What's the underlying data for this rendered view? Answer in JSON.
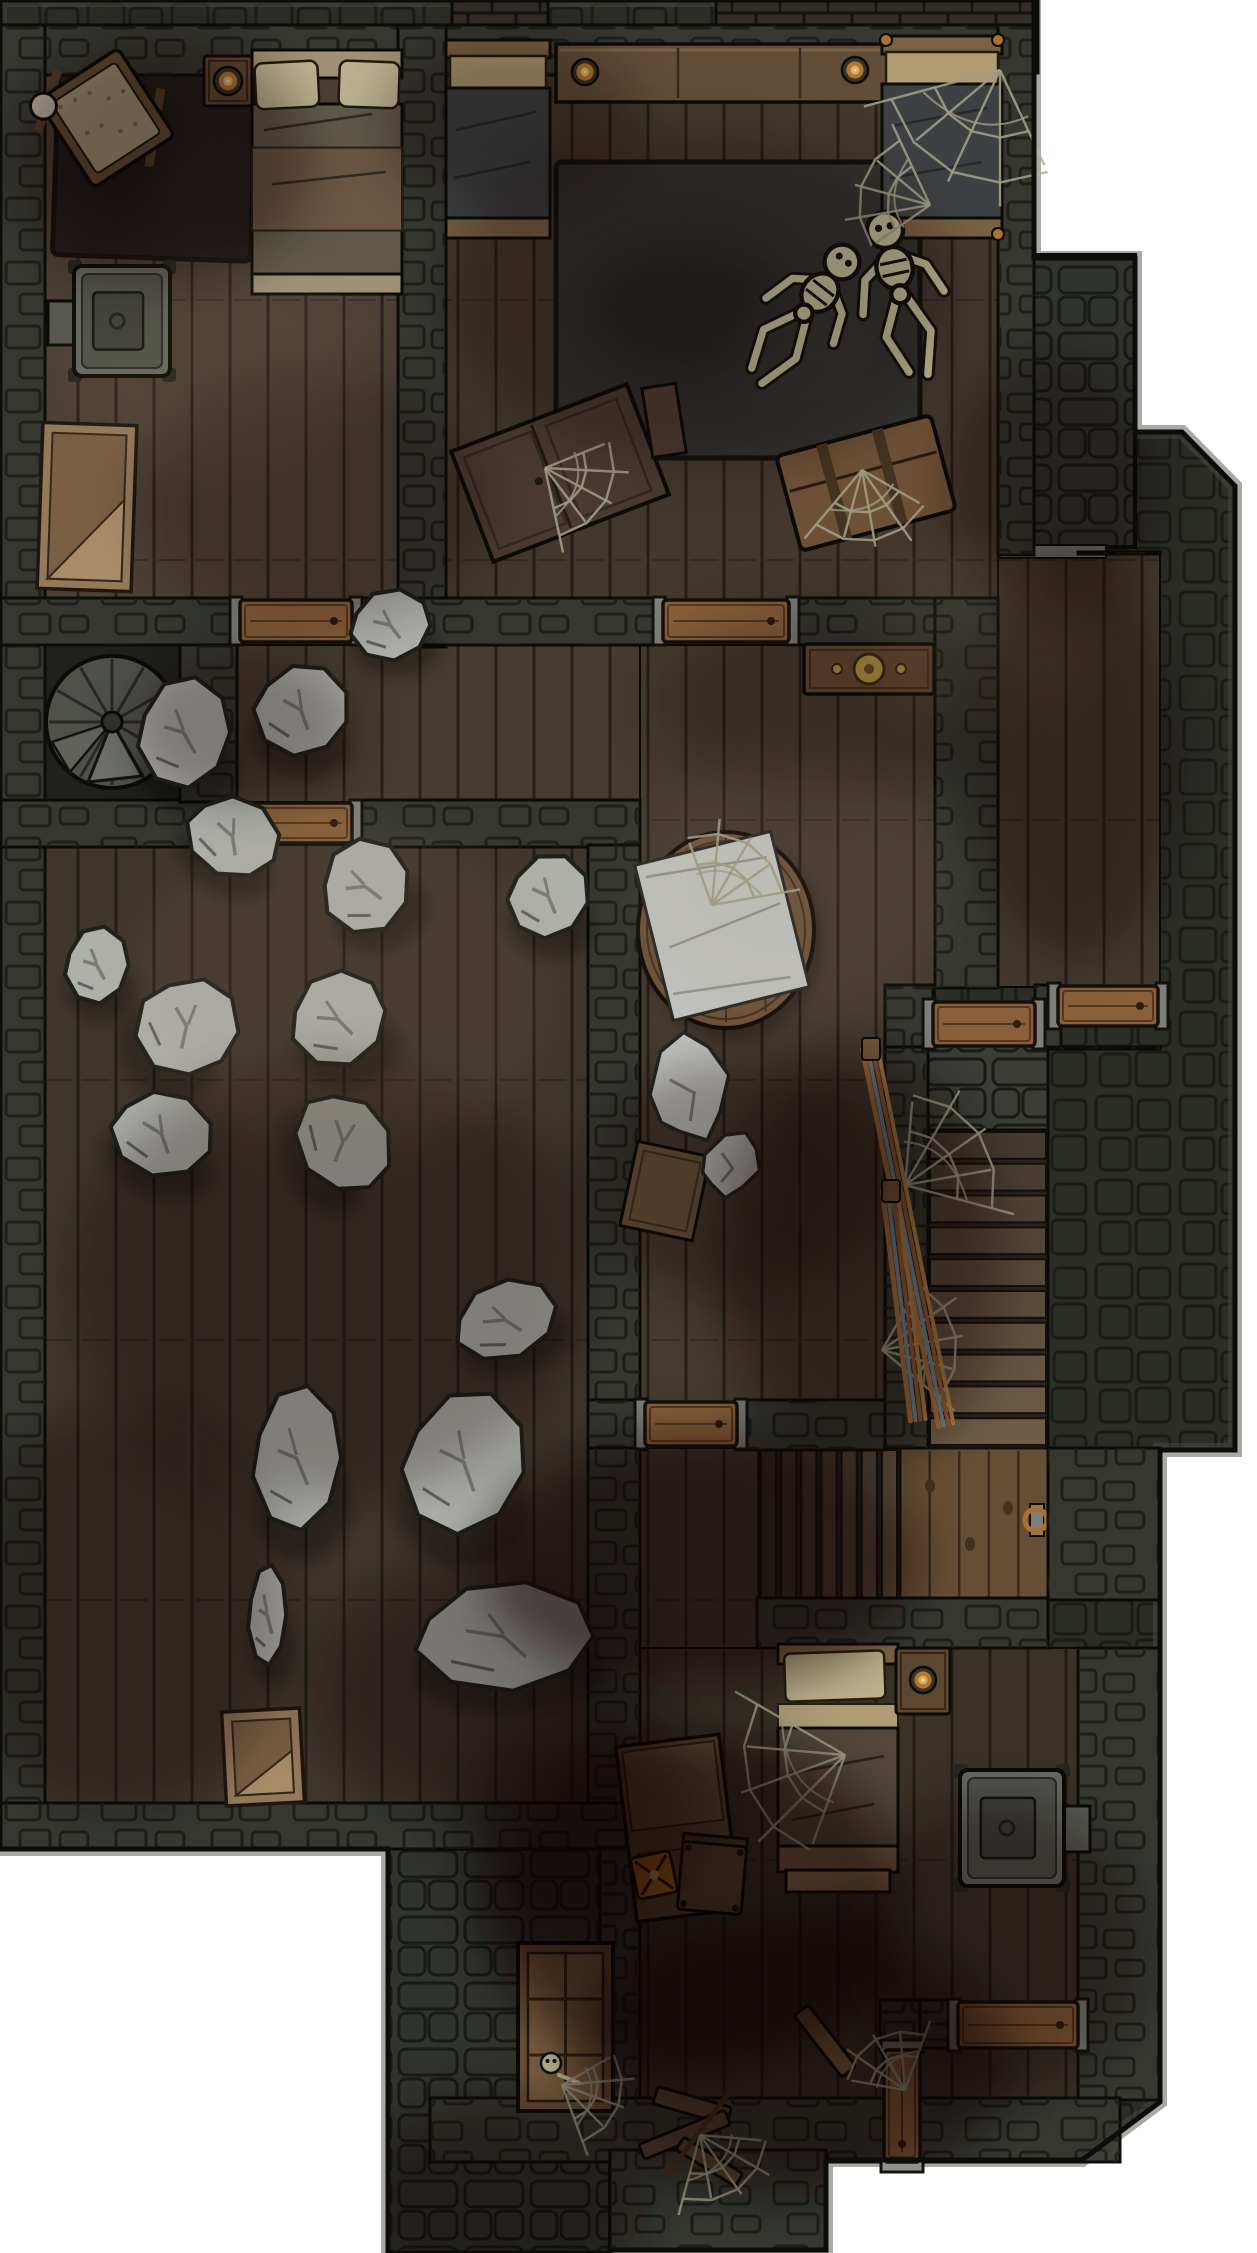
{
  "canvas": {
    "width": 1257,
    "height": 2253,
    "background": "#ffffff"
  },
  "palette": {
    "outline": "#0c0d09",
    "outer_wall": "#31332c",
    "outer_edge": "#54554d",
    "wall_fill": "#3d3f38",
    "brick_line": "#1d1e18",
    "cobble_base": "#383a34",
    "cobble_line": "#181914",
    "crenel_fill": "#3a332d",
    "crenel_line": "#171411",
    "floor_tones": {
      "a": "#57493c",
      "b": "#4c4034",
      "c": "#4f4337",
      "d": "#483d33",
      "e": "#42382e",
      "dark": "#24251f"
    },
    "seam": "rgba(14,10,7,0.55)",
    "door_wood": "#9c6c42",
    "door_edge": "#17120c",
    "door_jamb": "#8f918b",
    "threshold": "#878983",
    "rock_fill": "#c7c9c3",
    "rock_line": "#23241f",
    "rock_crease": "#8b8e88",
    "cloth_fill": "#dcdeda",
    "bone": "#ddd8ae",
    "web": "#b7b299",
    "rug_dark": "#262220",
    "rug_gray": "#3a3a37",
    "wood_mid": "#6f553d",
    "wood_light": "#a98a66",
    "wood_tan": "#b7a686",
    "pillow": "#d6caa4",
    "blanket_olive": "#6e6654",
    "blanket_slate": "#474a4c",
    "blanket_brown": "#5d5142",
    "stove_body": "#74776f",
    "stove_inner": "#5a5d55",
    "stove_door": "#474a43",
    "candle_ring": "#3f3a30",
    "candle_mid": "#cf8733",
    "candle_in": "#f4c979",
    "candle_dot": "#fff8d8",
    "gold": "#caa648",
    "peg_orange": "#c77f35",
    "broom_colors": [
      "#c28044",
      "#7e9aa8",
      "#a5683a",
      "#c9924f"
    ],
    "stair_top": "#4e4235",
    "stair_bottom": "#7e6950",
    "flight_dark": "#3a3127",
    "flight_light": "#6e5a45",
    "landing_wood": "#76593d",
    "spiral_fill": "#5a5d56",
    "spiral_hi": "#7e817a"
  },
  "silhouette": [
    [
      0,
      0
    ],
    [
      1034,
      0
    ],
    [
      1034,
      258
    ],
    [
      1135,
      258
    ],
    [
      1135,
      432
    ],
    [
      1182,
      432
    ],
    [
      1235,
      486
    ],
    [
      1235,
      1450
    ],
    [
      1160,
      1450
    ],
    [
      1160,
      2102
    ],
    [
      1082,
      2160
    ],
    [
      826,
      2160
    ],
    [
      826,
      2250
    ],
    [
      610,
      2250
    ],
    [
      610,
      2253
    ],
    [
      388,
      2253
    ],
    [
      388,
      1849
    ],
    [
      0,
      1849
    ]
  ],
  "crenellations": [
    {
      "x": 452,
      "y": 0,
      "w": 96,
      "h": 46
    },
    {
      "x": 716,
      "y": 0,
      "w": 322,
      "h": 73
    }
  ],
  "cobble_areas": [
    {
      "id": "east-entry-platform",
      "x": 958,
      "y": 255,
      "w": 177,
      "h": 292
    },
    {
      "id": "south-porch",
      "x": 388,
      "y": 1847,
      "w": 222,
      "h": 406
    }
  ],
  "floors": [
    {
      "id": "bedroom-nw",
      "x": 45,
      "y": 70,
      "w": 355,
      "h": 532,
      "tone": "a"
    },
    {
      "id": "bedroom-ne",
      "x": 446,
      "y": 70,
      "w": 552,
      "h": 532,
      "tone": "b"
    },
    {
      "id": "hallway",
      "x": 235,
      "y": 645,
      "w": 405,
      "h": 157,
      "tone": "c"
    },
    {
      "id": "stair-niche",
      "x": 45,
      "y": 645,
      "w": 137,
      "h": 157,
      "tone": "dark"
    },
    {
      "id": "great-room",
      "x": 640,
      "y": 645,
      "w": 295,
      "h": 757,
      "tone": "c"
    },
    {
      "id": "east-corridor",
      "x": 998,
      "y": 552,
      "w": 162,
      "h": 435,
      "tone": "b"
    },
    {
      "id": "rubble-room",
      "x": 45,
      "y": 845,
      "w": 545,
      "h": 958,
      "tone": "d"
    },
    {
      "id": "south-corridor",
      "x": 640,
      "y": 1448,
      "w": 119,
      "h": 202,
      "tone": "d"
    },
    {
      "id": "south-room",
      "x": 640,
      "y": 1648,
      "w": 438,
      "h": 452,
      "tone": "e"
    }
  ],
  "walls": [
    {
      "x": 0,
      "y": 25,
      "w": 1034,
      "h": 50
    },
    {
      "x": 0,
      "y": 25,
      "w": 45,
      "h": 1824
    },
    {
      "x": 398,
      "y": 25,
      "w": 48,
      "h": 622
    },
    {
      "x": 998,
      "y": 25,
      "w": 36,
      "h": 530
    },
    {
      "x": 0,
      "y": 598,
      "w": 240,
      "h": 47
    },
    {
      "x": 352,
      "y": 598,
      "w": 313,
      "h": 47
    },
    {
      "x": 789,
      "y": 598,
      "w": 209,
      "h": 47
    },
    {
      "x": 935,
      "y": 598,
      "w": 63,
      "h": 390
    },
    {
      "x": 0,
      "y": 800,
      "w": 240,
      "h": 47
    },
    {
      "x": 352,
      "y": 800,
      "w": 288,
      "h": 47
    },
    {
      "x": 180,
      "y": 645,
      "w": 57,
      "h": 157
    },
    {
      "x": 588,
      "y": 845,
      "w": 52,
      "h": 557
    },
    {
      "x": 0,
      "y": 1803,
      "w": 640,
      "h": 46
    },
    {
      "x": 588,
      "y": 1400,
      "w": 59,
      "h": 50
    },
    {
      "x": 737,
      "y": 1400,
      "w": 148,
      "h": 50
    },
    {
      "x": 885,
      "y": 985,
      "w": 48,
      "h": 62
    },
    {
      "x": 1035,
      "y": 985,
      "w": 26,
      "h": 62
    },
    {
      "x": 885,
      "y": 1047,
      "w": 43,
      "h": 401
    },
    {
      "x": 1048,
      "y": 1047,
      "w": 112,
      "h": 2
    },
    {
      "x": 1078,
      "y": 552,
      "w": 82,
      "h": 2
    },
    {
      "x": 1048,
      "y": 1448,
      "w": 112,
      "h": 152
    },
    {
      "x": 757,
      "y": 1598,
      "w": 291,
      "h": 50
    },
    {
      "x": 588,
      "y": 1448,
      "w": 52,
      "h": 355
    },
    {
      "x": 600,
      "y": 1847,
      "w": 40,
      "h": 255
    },
    {
      "x": 880,
      "y": 2000,
      "w": 42,
      "h": 50
    },
    {
      "x": 920,
      "y": 2000,
      "w": 38,
      "h": 48
    },
    {
      "x": 1078,
      "y": 2000,
      "w": 82,
      "h": 48
    },
    {
      "x": 1078,
      "y": 1648,
      "w": 82,
      "h": 452
    },
    {
      "x": 430,
      "y": 2098,
      "w": 690,
      "h": 64
    },
    {
      "x": 610,
      "y": 2150,
      "w": 216,
      "h": 100
    }
  ],
  "thresholds": [
    {
      "x": 1000,
      "y": 545,
      "w": 106,
      "h": 13
    },
    {
      "x": 740,
      "y": 2216,
      "w": 76,
      "h": 16
    }
  ],
  "doors": [
    {
      "id": "door-nw-hall",
      "x": 240,
      "y": 600,
      "w": 112,
      "h": 42
    },
    {
      "id": "door-hall-rubble",
      "x": 240,
      "y": 803,
      "w": 112,
      "h": 40
    },
    {
      "id": "door-ne-great",
      "x": 663,
      "y": 600,
      "w": 126,
      "h": 42
    },
    {
      "id": "door-corridor-east",
      "x": 1058,
      "y": 986,
      "w": 100,
      "h": 40
    },
    {
      "id": "door-stairs",
      "x": 933,
      "y": 1002,
      "w": 102,
      "h": 44
    },
    {
      "id": "door-great-south",
      "x": 645,
      "y": 1402,
      "w": 92,
      "h": 44
    },
    {
      "id": "door-south-alcove",
      "x": 958,
      "y": 2002,
      "w": 120,
      "h": 46
    },
    {
      "id": "door-divider",
      "x": 884,
      "y": 2050,
      "w": 36,
      "h": 112
    }
  ],
  "spiral_stair": {
    "cx": 112,
    "cy": 722,
    "r": 66
  },
  "stairs": {
    "top_landing": {
      "x": 928,
      "y": 1045,
      "w": 120,
      "h": 85
    },
    "flight_south": {
      "x": 928,
      "y": 1130,
      "w": 120,
      "h": 318,
      "steps": 10
    },
    "flight_west": {
      "x": 759,
      "y": 1448,
      "w": 141,
      "h": 152,
      "steps": 7
    },
    "landing": {
      "x": 900,
      "y": 1448,
      "w": 148,
      "h": 155,
      "ring_cx": 1036,
      "ring_cy": 1520
    }
  },
  "rugs": [
    {
      "id": "rug-nw",
      "x": 56,
      "y": 46,
      "w": 198,
      "h": 212,
      "rot": 2,
      "fill": "#262220"
    },
    {
      "id": "rug-ne",
      "x": 556,
      "y": 162,
      "w": 364,
      "h": 296,
      "rot": 0,
      "fill": "#3a3a37"
    }
  ],
  "furniture": [
    {
      "type": "cradle",
      "x": 58,
      "y": 66,
      "w": 96,
      "h": 104,
      "rot": -33
    },
    {
      "type": "side-table",
      "x": 204,
      "y": 56,
      "w": 48,
      "h": 50,
      "rot": 0
    },
    {
      "type": "candle",
      "cx": 228,
      "cy": 81,
      "r": 14
    },
    {
      "type": "bed-large",
      "x": 252,
      "y": 50,
      "w": 150,
      "h": 244,
      "rot": 0
    },
    {
      "type": "stove",
      "x": 74,
      "y": 266,
      "w": 96,
      "h": 110,
      "pipe": "left",
      "rot": 0
    },
    {
      "type": "crate-open",
      "x": 40,
      "y": 424,
      "w": 94,
      "h": 166,
      "rot": 2
    },
    {
      "type": "sideboard",
      "x": 556,
      "y": 44,
      "w": 366,
      "h": 58,
      "rot": 0
    },
    {
      "type": "candle",
      "cx": 585,
      "cy": 72,
      "r": 13
    },
    {
      "type": "candle",
      "cx": 855,
      "cy": 70,
      "r": 13
    },
    {
      "type": "bed-slate",
      "x": 446,
      "y": 40,
      "w": 104,
      "h": 198,
      "rot": 0,
      "webbed": false
    },
    {
      "type": "bed-slate",
      "x": 882,
      "y": 36,
      "w": 120,
      "h": 202,
      "rot": 0,
      "webbed": true
    },
    {
      "type": "wardrobe-fallen",
      "x": 466,
      "y": 414,
      "w": 188,
      "h": 118,
      "rot": -21
    },
    {
      "type": "trunk",
      "x": 786,
      "y": 434,
      "w": 160,
      "h": 98,
      "rot": -15
    },
    {
      "type": "chest",
      "x": 804,
      "y": 644,
      "w": 130,
      "h": 50,
      "rot": 0
    },
    {
      "type": "round-table",
      "cx": 726,
      "cy": 930,
      "rx": 88,
      "ry": 98
    },
    {
      "type": "cloth",
      "x": 652,
      "y": 846,
      "w": 140,
      "h": 160,
      "rot": -14
    },
    {
      "type": "box",
      "x": 628,
      "y": 1148,
      "w": 74,
      "h": 86,
      "rot": 12
    },
    {
      "type": "crate-open",
      "x": 224,
      "y": 1710,
      "w": 78,
      "h": 94,
      "rot": -3
    },
    {
      "type": "bed-south",
      "x": 778,
      "y": 1644,
      "w": 120,
      "h": 248,
      "rot": 0
    },
    {
      "type": "side-table",
      "x": 896,
      "y": 1648,
      "w": 54,
      "h": 66,
      "rot": 0
    },
    {
      "type": "candle",
      "cx": 923,
      "cy": 1680,
      "r": 13
    },
    {
      "type": "desk",
      "x": 626,
      "y": 1740,
      "w": 104,
      "h": 176,
      "rot": -7
    },
    {
      "type": "lantern",
      "x": 634,
      "y": 1854,
      "w": 40,
      "h": 42,
      "rot": -12
    },
    {
      "type": "chair",
      "x": 680,
      "y": 1844,
      "w": 64,
      "h": 68,
      "rot": 5
    },
    {
      "type": "stove",
      "x": 960,
      "y": 1770,
      "w": 104,
      "h": 116,
      "pipe": "right",
      "rot": 0
    },
    {
      "type": "plank",
      "x": 816,
      "y": 2002,
      "w": 18,
      "h": 78,
      "rot": -38
    },
    {
      "type": "stool-broken",
      "x": 638,
      "y": 2070,
      "w": 116,
      "h": 126,
      "rot": -8
    },
    {
      "type": "window-frame",
      "x": 518,
      "y": 1943,
      "w": 95,
      "h": 168,
      "rot": 0
    },
    {
      "type": "skull",
      "cx": 551,
      "cy": 2063,
      "r": 10
    }
  ],
  "rocks": [
    [
      348,
      588,
      84,
      74,
      0
    ],
    [
      252,
      662,
      98,
      96,
      15
    ],
    [
      135,
      675,
      97,
      115,
      0
    ],
    [
      183,
      795,
      99,
      83,
      30
    ],
    [
      318,
      838,
      94,
      97,
      -20
    ],
    [
      506,
      852,
      84,
      88,
      10
    ],
    [
      63,
      925,
      67,
      80,
      0
    ],
    [
      135,
      972,
      103,
      108,
      45
    ],
    [
      287,
      970,
      101,
      98,
      -10
    ],
    [
      108,
      1090,
      107,
      88,
      20
    ],
    [
      288,
      1095,
      110,
      93,
      60
    ],
    [
      450,
      1280,
      110,
      80,
      -15
    ],
    [
      250,
      1383,
      93,
      150,
      0
    ],
    [
      400,
      1387,
      127,
      150,
      10
    ],
    [
      247,
      1563,
      40,
      104,
      0
    ],
    [
      410,
      1580,
      187,
      113,
      0
    ]
  ],
  "bundles": [
    [
      645,
      1030,
      88,
      116,
      -10
    ],
    [
      700,
      1128,
      62,
      72,
      20
    ]
  ],
  "skeletons": [
    {
      "x": 885,
      "y": 230,
      "rot": -12,
      "scale": 1.5
    },
    {
      "x": 842,
      "y": 262,
      "rot": 38,
      "scale": 1.45
    }
  ],
  "webs": [
    [
      1000,
      70,
      150,
      115
    ],
    [
      930,
      205,
      95,
      -165
    ],
    [
      862,
      470,
      95,
      80
    ],
    [
      545,
      468,
      92,
      28
    ],
    [
      712,
      905,
      95,
      -60
    ],
    [
      905,
      1185,
      120,
      -35
    ],
    [
      882,
      1350,
      100,
      -10
    ],
    [
      845,
      1755,
      135,
      160
    ],
    [
      905,
      2090,
      78,
      -120
    ],
    [
      700,
      2135,
      88,
      55
    ],
    [
      562,
      2085,
      80,
      20
    ]
  ],
  "brooms": [
    [
      870,
      1048,
      946,
      1425
    ],
    [
      890,
      1190,
      918,
      1420
    ]
  ],
  "shadows": [
    [
      160,
      160,
      150,
      130,
      0.33
    ],
    [
      320,
      500,
      180,
      130,
      0.22
    ],
    [
      700,
      300,
      260,
      170,
      0.25
    ],
    [
      510,
      120,
      130,
      90,
      0.28
    ],
    [
      1075,
      760,
      110,
      200,
      0.3
    ],
    [
      830,
      700,
      180,
      100,
      0.22
    ],
    [
      330,
      1280,
      260,
      220,
      0.28
    ],
    [
      120,
      1610,
      170,
      200,
      0.3
    ],
    [
      480,
      1690,
      170,
      130,
      0.33
    ],
    [
      700,
      1560,
      220,
      130,
      0.5
    ],
    [
      690,
      1900,
      210,
      170,
      0.55
    ],
    [
      790,
      2060,
      220,
      140,
      0.5
    ],
    [
      995,
      1950,
      150,
      150,
      0.33
    ],
    [
      500,
      2200,
      150,
      105,
      0.38
    ],
    [
      1055,
      480,
      110,
      130,
      0.3
    ],
    [
      860,
      1260,
      140,
      210,
      0.38
    ],
    [
      740,
      1180,
      160,
      120,
      0.3
    ],
    [
      240,
      725,
      115,
      80,
      0.3
    ],
    [
      580,
      1820,
      120,
      120,
      0.35
    ]
  ],
  "lights": [
    [
      340,
      990,
      210,
      170,
      0.1
    ],
    [
      795,
      885,
      170,
      130,
      0.08
    ],
    [
      215,
      360,
      150,
      115,
      0.08
    ],
    [
      980,
      640,
      110,
      90,
      0.07
    ]
  ]
}
